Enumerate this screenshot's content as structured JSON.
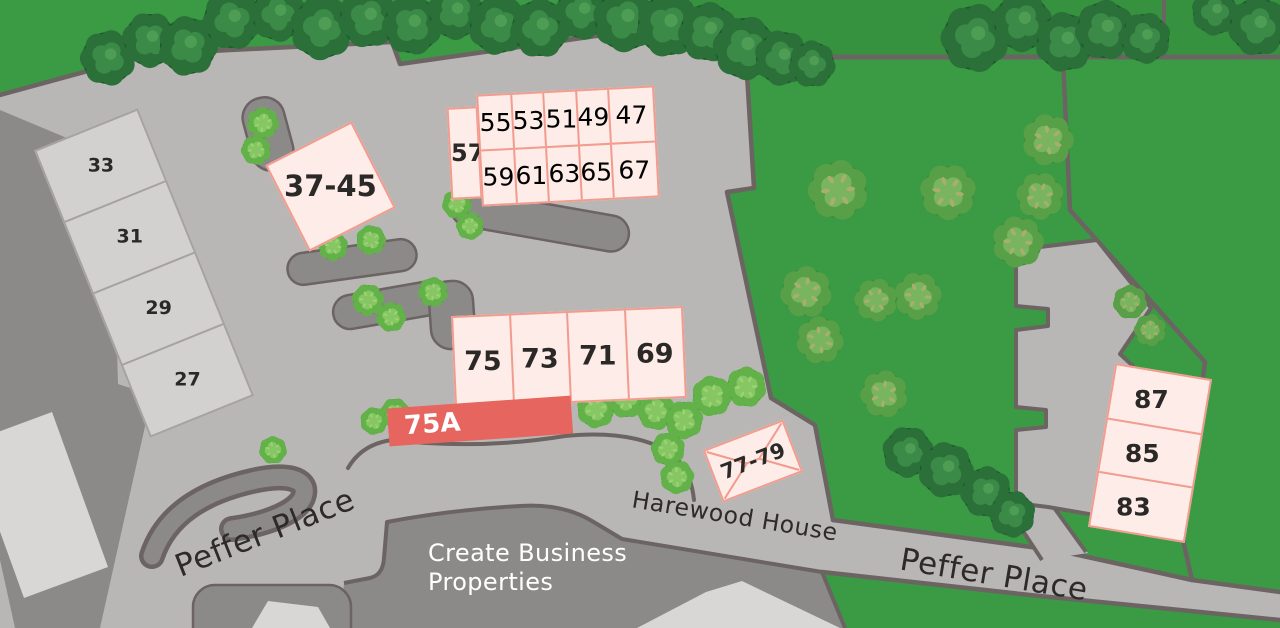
{
  "colors": {
    "grass": "#3b9a44",
    "grass_dark": "#37923f",
    "pavement": "#b9b7b6",
    "line": "#6b6462",
    "building_dark": "#8c8a89",
    "building_light": "#d9d7d5",
    "terrace_fill": "#d3d1cf",
    "terrace_line": "#a5a2a0",
    "plot_fill": "#fdece7",
    "plot_border": "#f19c8e",
    "highlight_fill": "#e6655e",
    "label": "#2b2928",
    "road_label": "#2d2a28",
    "white": "#ffffff"
  },
  "brand": {
    "line1": "Create Business",
    "line2": "Properties"
  },
  "road_labels": [
    {
      "id": "peffer-place-west",
      "text": "Peffer Place"
    },
    {
      "id": "harewood-house",
      "text": "Harewood House"
    },
    {
      "id": "peffer-place-east",
      "text": "Peffer Place"
    }
  ],
  "unit_groups": [
    {
      "id": "terrace-33-27",
      "kind": "existing",
      "dir": "col",
      "cx": 144,
      "cy": 273,
      "w": 112,
      "h": 310,
      "rot": -22,
      "labelRot": 22,
      "fontSize": 19,
      "cells": [
        "33",
        "31",
        "29",
        "27"
      ]
    },
    {
      "id": "plot-37-45",
      "kind": "available",
      "dir": "row",
      "cx": 330,
      "cy": 186,
      "w": 97,
      "h": 97,
      "rot": -27,
      "labelRot": 27,
      "fontSize": 29,
      "cells": [
        "37-45"
      ]
    },
    {
      "id": "plot-57",
      "kind": "available",
      "dir": "row",
      "cx": 464,
      "cy": 153,
      "w": 31,
      "h": 92,
      "rot": -3,
      "labelRot": 3,
      "fontSize": 24,
      "cells": [
        "57"
      ]
    },
    {
      "id": "block-47-67",
      "kind": "grid",
      "cx": 568,
      "cy": 146,
      "w": 178,
      "h": 112,
      "rot": -3,
      "labelRot": 3,
      "fontSize": 25,
      "grid": {
        "rows": [
          [
            "55",
            "53",
            "51",
            "49",
            "47"
          ],
          [
            "59",
            "61",
            "63",
            "65",
            "67"
          ]
        ],
        "colWidths": [
          18.5,
          18.5,
          18.5,
          18.5,
          26
        ]
      }
    },
    {
      "id": "terrace-75-69",
      "kind": "available",
      "dir": "row",
      "cx": 569,
      "cy": 357,
      "w": 232,
      "h": 92,
      "rot": -2.5,
      "labelRot": 2.5,
      "fontSize": 27,
      "cells": [
        "75",
        "73",
        "71",
        "69"
      ]
    },
    {
      "id": "building-75a",
      "kind": "highlight",
      "dir": "row",
      "cx": 480,
      "cy": 421,
      "w": 184,
      "h": 38,
      "rot": -4,
      "labelRot": 0,
      "fontSize": 26,
      "cells": [
        "75A"
      ]
    },
    {
      "id": "plot-77-79",
      "kind": "envelope",
      "dir": "row",
      "cx": 753,
      "cy": 461,
      "w": 86,
      "h": 56,
      "rot": -21,
      "labelRot": 0,
      "fontSize": 21,
      "cells": [
        "77-79"
      ]
    },
    {
      "id": "terrace-87-83",
      "kind": "available",
      "dir": "col",
      "cx": 1150,
      "cy": 453,
      "w": 98,
      "h": 166,
      "rot": 9.5,
      "labelRot": -9.5,
      "labelDx": -8,
      "fontSize": 25,
      "cells": [
        "87",
        "85",
        "83"
      ]
    }
  ],
  "vegetation": {
    "trees": [
      [
        108,
        58,
        26,
        "a"
      ],
      [
        150,
        40,
        26,
        "a"
      ],
      [
        188,
        46,
        28,
        "a"
      ],
      [
        232,
        20,
        28,
        "a"
      ],
      [
        278,
        14,
        26,
        "a"
      ],
      [
        322,
        28,
        30,
        "a"
      ],
      [
        368,
        18,
        28,
        "a"
      ],
      [
        412,
        25,
        28,
        "a"
      ],
      [
        455,
        12,
        26,
        "a"
      ],
      [
        498,
        25,
        28,
        "a"
      ],
      [
        540,
        28,
        28,
        "a"
      ],
      [
        582,
        12,
        26,
        "a"
      ],
      [
        625,
        20,
        30,
        "a"
      ],
      [
        668,
        25,
        30,
        "a"
      ],
      [
        708,
        32,
        28,
        "a"
      ],
      [
        745,
        48,
        30,
        "a"
      ],
      [
        782,
        58,
        26,
        "a"
      ],
      [
        812,
        64,
        22,
        "a"
      ],
      [
        975,
        38,
        32,
        "a"
      ],
      [
        1022,
        22,
        28,
        "a"
      ],
      [
        1065,
        42,
        28,
        "a"
      ],
      [
        1105,
        30,
        28,
        "a"
      ],
      [
        1145,
        38,
        24,
        "a"
      ],
      [
        1215,
        12,
        22,
        "a"
      ],
      [
        1258,
        26,
        28,
        "a"
      ],
      [
        838,
        190,
        28,
        "b"
      ],
      [
        948,
        192,
        26,
        "b"
      ],
      [
        1048,
        140,
        24,
        "b"
      ],
      [
        806,
        292,
        24,
        "b"
      ],
      [
        876,
        300,
        20,
        "b"
      ],
      [
        918,
        296,
        22,
        "b"
      ],
      [
        820,
        340,
        22,
        "b"
      ],
      [
        884,
        394,
        22,
        "b"
      ],
      [
        1040,
        196,
        22,
        "b"
      ],
      [
        1018,
        242,
        24,
        "b"
      ],
      [
        1130,
        302,
        16,
        "b"
      ],
      [
        1150,
        330,
        15,
        "b"
      ],
      [
        908,
        452,
        24,
        "a"
      ],
      [
        946,
        470,
        26,
        "a"
      ],
      [
        986,
        492,
        24,
        "a"
      ],
      [
        1012,
        514,
        22,
        "a"
      ],
      [
        596,
        409,
        18,
        "c"
      ],
      [
        626,
        399,
        18,
        "c"
      ],
      [
        656,
        411,
        18,
        "c"
      ],
      [
        684,
        420,
        18,
        "c"
      ],
      [
        712,
        396,
        19,
        "c"
      ],
      [
        746,
        387,
        19,
        "c"
      ],
      [
        668,
        449,
        16,
        "c"
      ],
      [
        677,
        477,
        16,
        "c"
      ],
      [
        263,
        123,
        15,
        "c"
      ],
      [
        256,
        150,
        14,
        "c"
      ],
      [
        333,
        246,
        14,
        "c"
      ],
      [
        371,
        240,
        14,
        "c"
      ],
      [
        457,
        204,
        14,
        "c"
      ],
      [
        470,
        226,
        13,
        "c"
      ],
      [
        368,
        300,
        15,
        "c"
      ],
      [
        391,
        317,
        14,
        "c"
      ],
      [
        433,
        292,
        14,
        "c"
      ],
      [
        395,
        413,
        14,
        "c"
      ],
      [
        374,
        421,
        13,
        "c"
      ],
      [
        273,
        450,
        13,
        "c"
      ]
    ]
  }
}
